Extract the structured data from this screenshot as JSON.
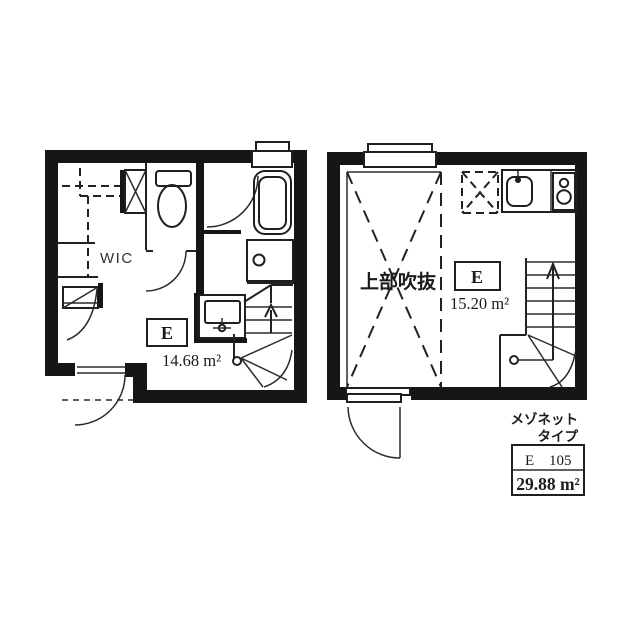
{
  "left_plan": {
    "wic_label": "WIC",
    "room_label": "E",
    "area": "14.68 m²"
  },
  "right_plan": {
    "void_label": "上部吹抜",
    "room_label": "E",
    "area": "15.20 m²"
  },
  "caption": {
    "line1": "メゾネット",
    "line2": "タイプ"
  },
  "unit_box": {
    "unit_letter": "E",
    "unit_number": "105",
    "total_area": "29.88 m²"
  }
}
